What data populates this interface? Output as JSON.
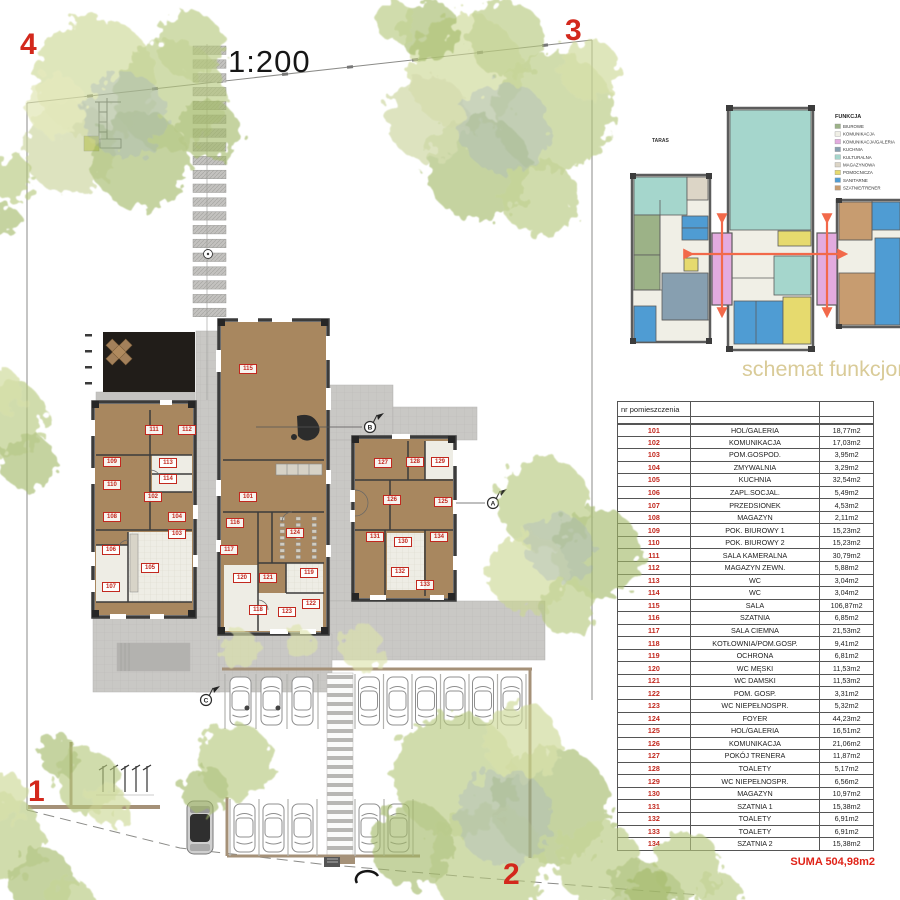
{
  "scale_label": "1:200",
  "corner_markers": [
    {
      "label": "4",
      "x": 20,
      "y": 30
    },
    {
      "label": "3",
      "x": 565,
      "y": 16
    },
    {
      "label": "1",
      "x": 28,
      "y": 777
    },
    {
      "label": "2",
      "x": 503,
      "y": 860
    }
  ],
  "plan": {
    "section_markers": [
      {
        "label": "B",
        "x": 370,
        "y": 427
      },
      {
        "label": "A",
        "x": 493,
        "y": 503
      },
      {
        "label": "C",
        "x": 206,
        "y": 700
      }
    ],
    "room_tags": [
      {
        "no": "111",
        "x": 154,
        "y": 430
      },
      {
        "no": "112",
        "x": 187,
        "y": 430
      },
      {
        "no": "113",
        "x": 168,
        "y": 463
      },
      {
        "no": "114",
        "x": 168,
        "y": 479
      },
      {
        "no": "109",
        "x": 112,
        "y": 462
      },
      {
        "no": "110",
        "x": 112,
        "y": 485
      },
      {
        "no": "102",
        "x": 153,
        "y": 497
      },
      {
        "no": "108",
        "x": 112,
        "y": 517
      },
      {
        "no": "104",
        "x": 177,
        "y": 517
      },
      {
        "no": "103",
        "x": 177,
        "y": 534
      },
      {
        "no": "106",
        "x": 111,
        "y": 550
      },
      {
        "no": "105",
        "x": 150,
        "y": 568
      },
      {
        "no": "107",
        "x": 111,
        "y": 587
      },
      {
        "no": "115",
        "x": 248,
        "y": 369
      },
      {
        "no": "101",
        "x": 248,
        "y": 497
      },
      {
        "no": "124",
        "x": 295,
        "y": 533
      },
      {
        "no": "116",
        "x": 235,
        "y": 523
      },
      {
        "no": "117",
        "x": 229,
        "y": 550
      },
      {
        "no": "120",
        "x": 242,
        "y": 578
      },
      {
        "no": "121",
        "x": 268,
        "y": 578
      },
      {
        "no": "119",
        "x": 309,
        "y": 573
      },
      {
        "no": "122",
        "x": 311,
        "y": 604
      },
      {
        "no": "123",
        "x": 287,
        "y": 612
      },
      {
        "no": "118",
        "x": 258,
        "y": 610
      },
      {
        "no": "127",
        "x": 383,
        "y": 463
      },
      {
        "no": "128",
        "x": 415,
        "y": 462
      },
      {
        "no": "129",
        "x": 440,
        "y": 462
      },
      {
        "no": "126",
        "x": 392,
        "y": 500
      },
      {
        "no": "125",
        "x": 443,
        "y": 502
      },
      {
        "no": "131",
        "x": 375,
        "y": 537
      },
      {
        "no": "130",
        "x": 403,
        "y": 542
      },
      {
        "no": "134",
        "x": 439,
        "y": 537
      },
      {
        "no": "132",
        "x": 400,
        "y": 572
      },
      {
        "no": "133",
        "x": 425,
        "y": 585
      }
    ]
  },
  "schematic": {
    "caption": "schemat funkcjona",
    "taras_label": "TARAS",
    "legend_title": "FUNKCJA",
    "legend": [
      {
        "label": "BIUROWE",
        "color": "#9cb287"
      },
      {
        "label": "KOMUNIKACJA",
        "color": "#f0efe6"
      },
      {
        "label": "KOMUNIKACJA/GALERIA",
        "color": "#e3abdf"
      },
      {
        "label": "KUCHNIA",
        "color": "#879fb0"
      },
      {
        "label": "KULTURALNA",
        "color": "#a5d6cc"
      },
      {
        "label": "MAGAZYNOWA",
        "color": "#dcd5c6"
      },
      {
        "label": "POMOCNICZA",
        "color": "#e6da6e"
      },
      {
        "label": "SANITARNE",
        "color": "#4f9cd3"
      },
      {
        "label": "SZATNIE/TRENER",
        "color": "#c79c70"
      }
    ],
    "accent_arrow_color": "#f2694a"
  },
  "rooms_table": {
    "header": "nr pomieszczenia",
    "rows": [
      {
        "no": "101",
        "name": "HOL/GALERIA",
        "area": "18,77m2"
      },
      {
        "no": "102",
        "name": "KOMUNIKACJA",
        "area": "17,03m2"
      },
      {
        "no": "103",
        "name": "POM.GOSPOD.",
        "area": "3,95m2"
      },
      {
        "no": "104",
        "name": "ZMYWALNIA",
        "area": "3,29m2"
      },
      {
        "no": "105",
        "name": "KUCHNIA",
        "area": "32,54m2"
      },
      {
        "no": "106",
        "name": "ZAPL.SOCJAL.",
        "area": "5,49m2"
      },
      {
        "no": "107",
        "name": "PRZEDSIONEK",
        "area": "4,53m2"
      },
      {
        "no": "108",
        "name": "MAGAZYN",
        "area": "2,11m2"
      },
      {
        "no": "109",
        "name": "POK. BIUROWY 1",
        "area": "15,23m2"
      },
      {
        "no": "110",
        "name": "POK. BIUROWY 2",
        "area": "15,23m2"
      },
      {
        "no": "111",
        "name": "SALA KAMERALNA",
        "area": "30,79m2"
      },
      {
        "no": "112",
        "name": "MAGAZYN ZEWN.",
        "area": "5,88m2"
      },
      {
        "no": "113",
        "name": "WC",
        "area": "3,04m2"
      },
      {
        "no": "114",
        "name": "WC",
        "area": "3,04m2"
      },
      {
        "no": "115",
        "name": "SALA",
        "area": "106,87m2"
      },
      {
        "no": "116",
        "name": "SZATNIA",
        "area": "6,85m2"
      },
      {
        "no": "117",
        "name": "SALA CIEMNA",
        "area": "21,53m2"
      },
      {
        "no": "118",
        "name": "KOTŁOWNIA/POM.GOSP.",
        "area": "9,41m2"
      },
      {
        "no": "119",
        "name": "OCHRONA",
        "area": "6,81m2"
      },
      {
        "no": "120",
        "name": "WC MĘSKI",
        "area": "11,53m2"
      },
      {
        "no": "121",
        "name": "WC DAMSKI",
        "area": "11,53m2"
      },
      {
        "no": "122",
        "name": "POM. GOSP.",
        "area": "3,31m2"
      },
      {
        "no": "123",
        "name": "WC NIEPEŁNOSPR.",
        "area": "5,32m2"
      },
      {
        "no": "124",
        "name": "FOYER",
        "area": "44,23m2"
      },
      {
        "no": "125",
        "name": "HOL/GALERIA",
        "area": "16,51m2"
      },
      {
        "no": "126",
        "name": "KOMUNIKACJA",
        "area": "21,06m2"
      },
      {
        "no": "127",
        "name": "POKÓJ TRENERA",
        "area": "11,87m2"
      },
      {
        "no": "128",
        "name": "TOALETY",
        "area": "5,17m2"
      },
      {
        "no": "129",
        "name": "WC NIEPEŁNOSPR.",
        "area": "6,56m2"
      },
      {
        "no": "130",
        "name": "MAGAZYN",
        "area": "10,97m2"
      },
      {
        "no": "131",
        "name": "SZATNIA 1",
        "area": "15,38m2"
      },
      {
        "no": "132",
        "name": "TOALETY",
        "area": "6,91m2"
      },
      {
        "no": "133",
        "name": "TOALETY",
        "area": "6,91m2"
      },
      {
        "no": "134",
        "name": "SZATNIA 2",
        "area": "15,38m2"
      }
    ],
    "sum_label": "SUMA 504,98m2"
  }
}
